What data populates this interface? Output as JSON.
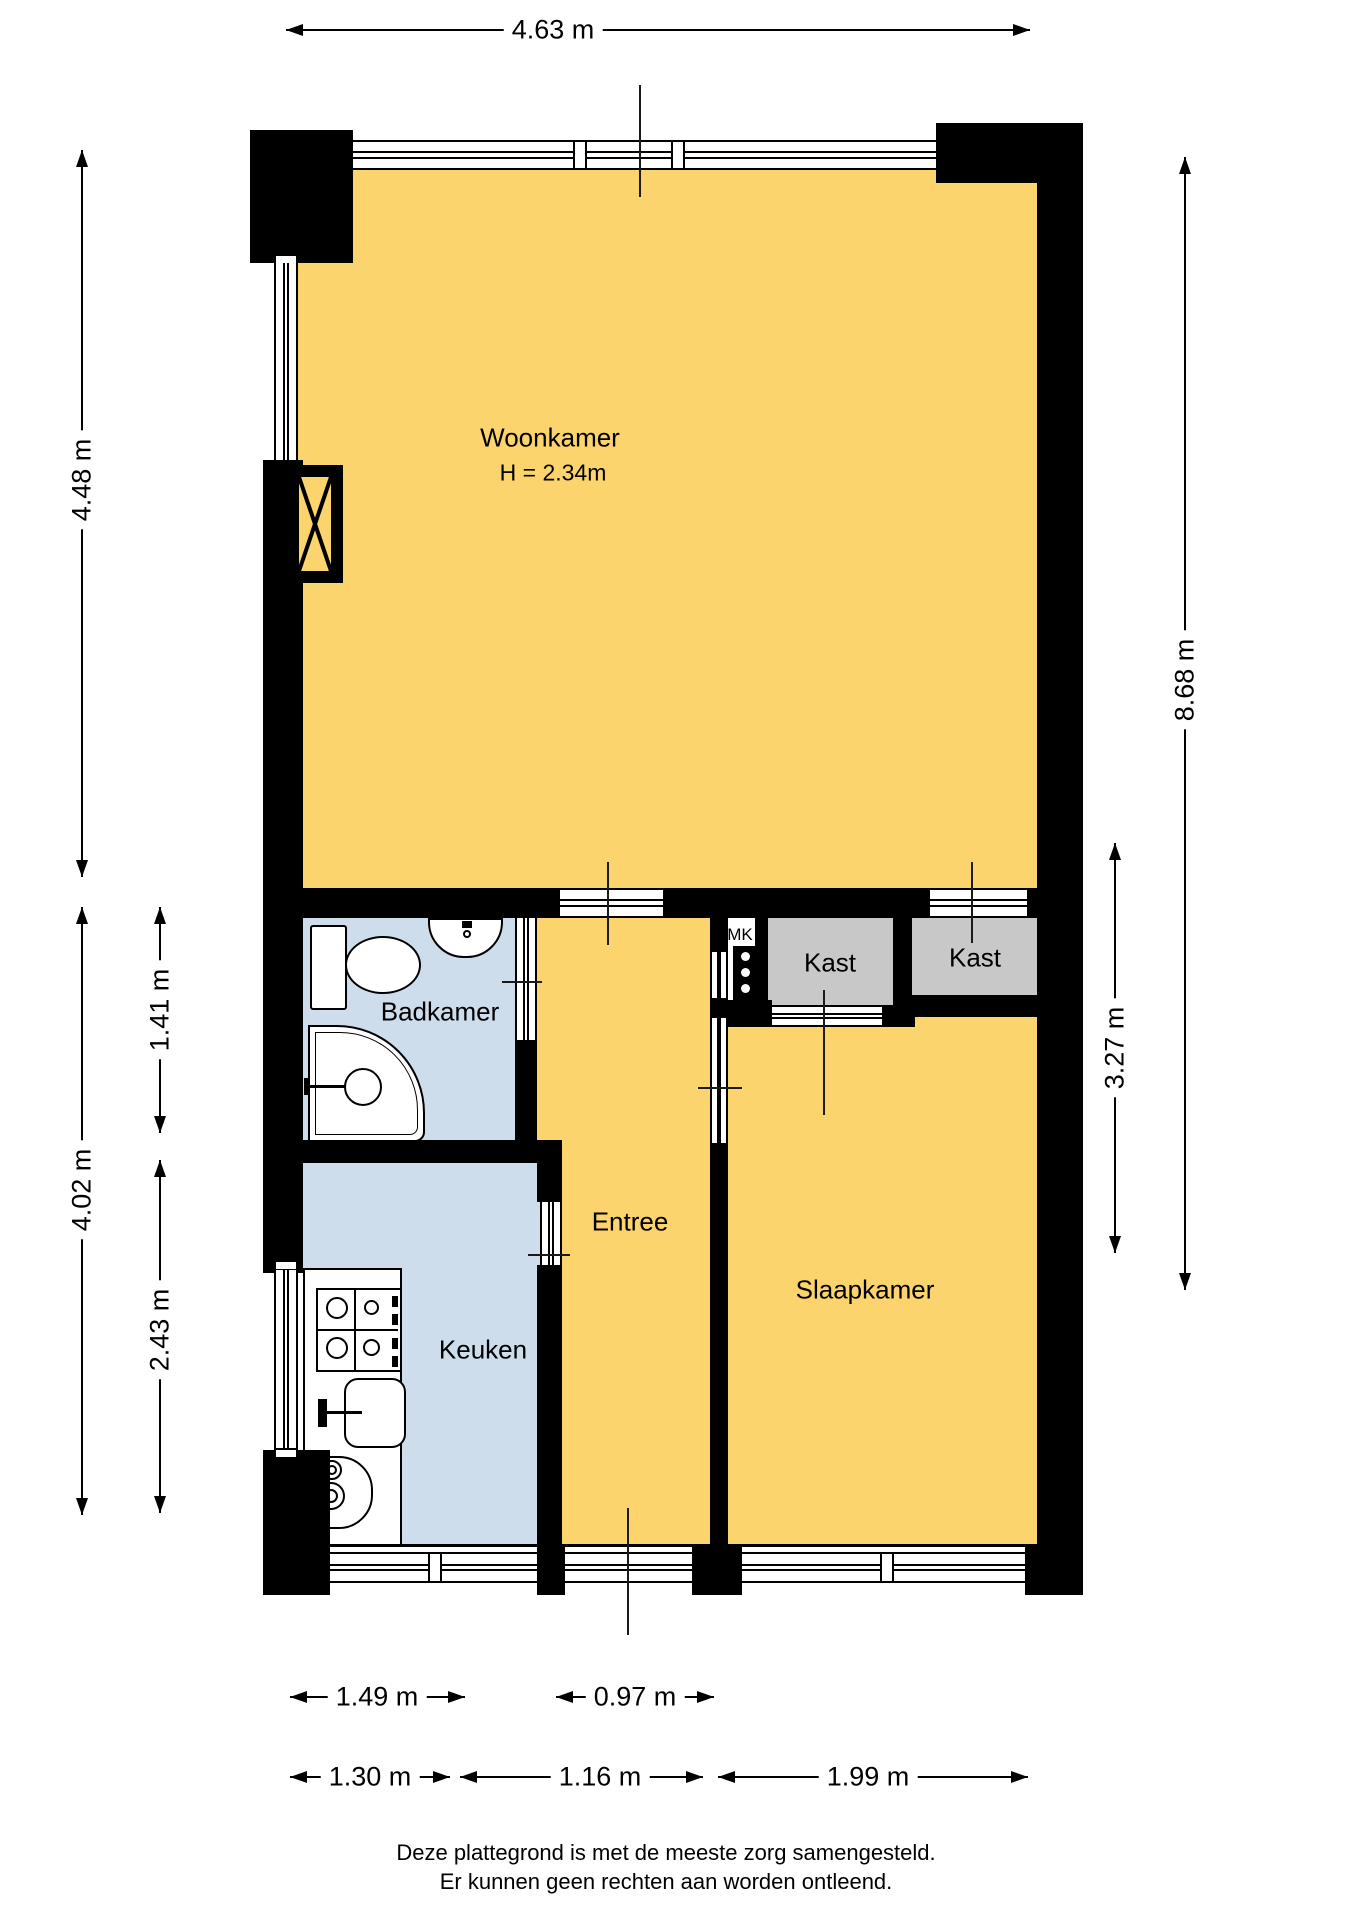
{
  "colors": {
    "wall": "#000000",
    "floor_main": "#FBD46D",
    "floor_wet": "#CEDDEB",
    "closet": "#C8C8C8",
    "paper": "#FFFFFF"
  },
  "rooms": {
    "woonkamer": {
      "label": "Woonkamer",
      "ceiling_height": "H = 2.34m"
    },
    "badkamer": {
      "label": "Badkamer"
    },
    "entree": {
      "label": "Entree"
    },
    "keuken": {
      "label": "Keuken"
    },
    "slaapkamer": {
      "label": "Slaapkamer"
    },
    "kast1": {
      "label": "Kast"
    },
    "kast2": {
      "label": "Kast"
    },
    "meterkast": {
      "label": "MK"
    }
  },
  "dimensions": {
    "top_width": "4.63 m",
    "left_living_height": "4.48 m",
    "left_lower_height": "4.02 m",
    "left_bathroom_height": "1.41 m",
    "left_kitchen_height": "2.43 m",
    "right_total_height": "8.68 m",
    "right_bedroom_height": "3.27 m",
    "bottom_kitchen_window": "1.49 m",
    "bottom_entree_window": "0.97 m",
    "bottom_kitchen_width": "1.30 m",
    "bottom_entree_width": "1.16 m",
    "bottom_bedroom_width": "1.99 m"
  },
  "footer": {
    "line1": "Deze plattegrond is met de meeste zorg samengesteld.",
    "line2": "Er kunnen geen rechten aan worden ontleend."
  }
}
